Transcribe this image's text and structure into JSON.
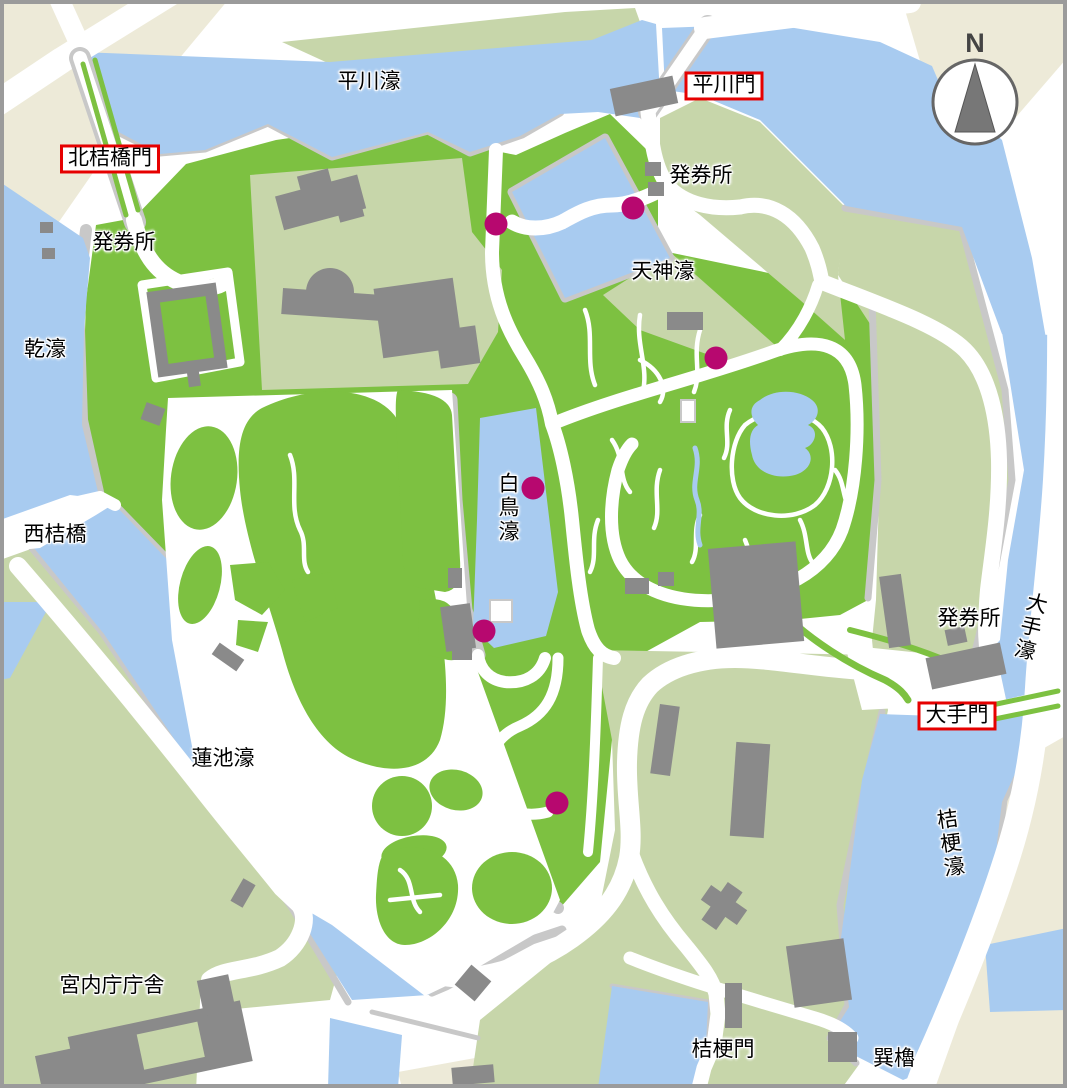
{
  "colors": {
    "water": "#A8CBF0",
    "park": "#7DC141",
    "pale": "#C7D6AA",
    "beige": "#EDEAD8",
    "building": "#8A8A8A",
    "wall": "#C8C8C8",
    "dot": "#B7086F",
    "box_border": "#E60000",
    "frame": "#9B9B9B",
    "compass": "#777777"
  },
  "map": {
    "labels": [
      {
        "id": "hirakawa-moat",
        "text": "平川濠",
        "x": 369,
        "y": 82,
        "kind": "plain"
      },
      {
        "id": "hirakawa-gate",
        "text": "平川門",
        "x": 724,
        "y": 86,
        "kind": "boxed"
      },
      {
        "id": "kitahanebashi-gate",
        "text": "北桔橋門",
        "x": 110,
        "y": 159,
        "kind": "boxed"
      },
      {
        "id": "ticket-office-hirakawa",
        "text": "発券所",
        "x": 701,
        "y": 176,
        "kind": "plain"
      },
      {
        "id": "ticket-office-kitahanebashi",
        "text": "発券所",
        "x": 124,
        "y": 243,
        "kind": "plain"
      },
      {
        "id": "tenjin-moat",
        "text": "天神濠",
        "x": 663,
        "y": 272,
        "kind": "plain"
      },
      {
        "id": "inui-moat",
        "text": "乾濠",
        "x": 45,
        "y": 350,
        "kind": "plain"
      },
      {
        "id": "nishihanebashi-bridge",
        "text": "西桔橋",
        "x": 55,
        "y": 535,
        "kind": "plain"
      },
      {
        "id": "hakucho-moat",
        "text": "白鳥濠",
        "x": 507,
        "y": 508,
        "kind": "vertical"
      },
      {
        "id": "ticket-office-ote",
        "text": "発券所",
        "x": 969,
        "y": 619,
        "kind": "plain"
      },
      {
        "id": "ote-moat",
        "text": "大手濠",
        "x": 1029,
        "y": 627,
        "kind": "vertical",
        "rotate": 14
      },
      {
        "id": "ote-gate",
        "text": "大手門",
        "x": 957,
        "y": 716,
        "kind": "boxed"
      },
      {
        "id": "kikyo-moat",
        "text": "桔梗濠",
        "x": 949,
        "y": 844,
        "kind": "vertical",
        "rotate": -8
      },
      {
        "id": "hasuike-moat",
        "text": "蓮池濠",
        "x": 223,
        "y": 759,
        "kind": "plain"
      },
      {
        "id": "kunaicho-building",
        "text": "宮内庁庁舎",
        "x": 112,
        "y": 986,
        "kind": "plain"
      },
      {
        "id": "kikyo-gate",
        "text": "桔梗門",
        "x": 723,
        "y": 1050,
        "kind": "plain"
      },
      {
        "id": "tatsumi-turret",
        "text": "巽櫓",
        "x": 894,
        "y": 1059,
        "kind": "plain"
      }
    ],
    "checkpoints": [
      {
        "x": 496,
        "y": 224
      },
      {
        "x": 633,
        "y": 208
      },
      {
        "x": 716,
        "y": 358
      },
      {
        "x": 533,
        "y": 488
      },
      {
        "x": 484,
        "y": 631
      },
      {
        "x": 557,
        "y": 803
      }
    ],
    "compass": {
      "label": "N"
    }
  }
}
